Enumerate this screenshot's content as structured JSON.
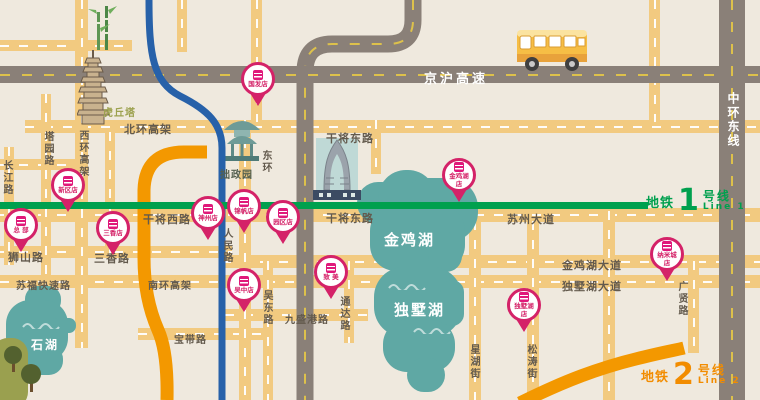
{
  "colors": {
    "background": "#EFE9DE",
    "road_yellow": "#F2CA80",
    "road_gray": "#8A8078",
    "lake_teal": "#5FA8A4",
    "metro_green": "#00A04E",
    "metro_orange": "#F39800",
    "metro_blue": "#2761A9",
    "pin_pink": "#D42268"
  },
  "highways": {
    "jinghu": "京沪高速",
    "zhonghuan": "中环东线"
  },
  "landmarks": {
    "huqiu": "虎丘塔",
    "zhuozhengyuan": "拙政园",
    "donghuan": "东环"
  },
  "lakes": {
    "jinji": "金鸡湖",
    "dushu": "独墅湖",
    "shihu": "石湖"
  },
  "metro": {
    "line1": {
      "prefix": "地铁",
      "number": "1",
      "suffix": "号线",
      "en": "Line 1"
    },
    "line2": {
      "prefix": "地铁",
      "number": "2",
      "suffix": "号线",
      "en": "Line 2"
    }
  },
  "roads": {
    "labels": [
      {
        "text": "北环高架"
      },
      {
        "text": "西环高架"
      },
      {
        "text": "塔园路"
      },
      {
        "text": "长江路"
      },
      {
        "text": "干将西路"
      },
      {
        "text": "干将东路"
      },
      {
        "text": "干将东路"
      },
      {
        "text": "苏州大道"
      },
      {
        "text": "狮山路"
      },
      {
        "text": "三香路"
      },
      {
        "text": "苏福快速路"
      },
      {
        "text": "南环高架"
      },
      {
        "text": "宝带路"
      },
      {
        "text": "人民路"
      },
      {
        "text": "吴东路"
      },
      {
        "text": "九盛港路"
      },
      {
        "text": "通达路"
      },
      {
        "text": "星湖街"
      },
      {
        "text": "松涛街"
      },
      {
        "text": "金鸡湖大道"
      },
      {
        "text": "独墅湖大道"
      },
      {
        "text": "广贤路"
      }
    ]
  },
  "stores": [
    {
      "name": "国发店"
    },
    {
      "name": "新区店"
    },
    {
      "name": "总 部"
    },
    {
      "name": "三香店"
    },
    {
      "name": "神州店"
    },
    {
      "name": "锦帆店"
    },
    {
      "name": "园区店"
    },
    {
      "name": "金鸡湖店"
    },
    {
      "name": "吴中店"
    },
    {
      "name": "致 美"
    },
    {
      "name": "独墅湖店"
    },
    {
      "name": "纳米城店"
    }
  ]
}
